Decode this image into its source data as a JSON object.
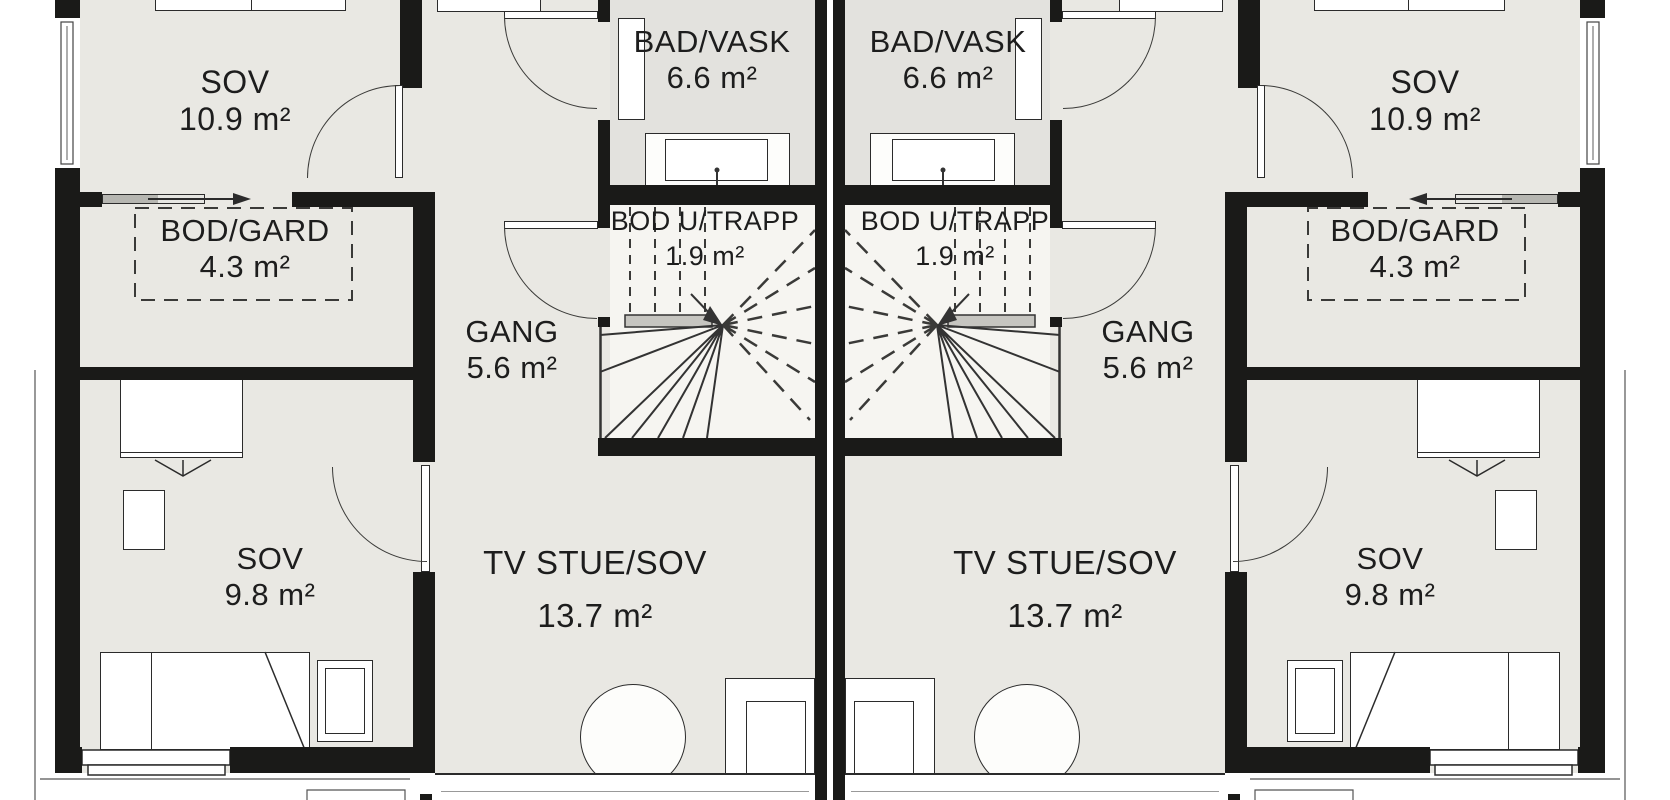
{
  "title": "Floor plan - two mirrored dwelling units (upper storey)",
  "rooms": {
    "sov_top": {
      "name": "SOV",
      "area": "10.9 m²"
    },
    "bad_vask": {
      "name": "BAD/VASK",
      "area": "6.6 m²"
    },
    "bod_gard": {
      "name": "BOD/GARD",
      "area": "4.3 m²"
    },
    "bod_u_trapp": {
      "name": "BOD U/TRAPP",
      "area": "1.9 m²"
    },
    "gang": {
      "name": "GANG",
      "area": "5.6 m²"
    },
    "sov_bottom": {
      "name": "SOV",
      "area": "9.8 m²"
    },
    "tv_stue": {
      "name": "TV STUE/SOV",
      "area": "13.7 m²"
    }
  },
  "colors": {
    "wall": "#1a1a18",
    "floor": "#e9e8e3",
    "floor_bad": "#e3e2de",
    "floor_stair": "#f6f5f1",
    "line": "#2e2e2c",
    "handrail": "#c6c5c0"
  }
}
